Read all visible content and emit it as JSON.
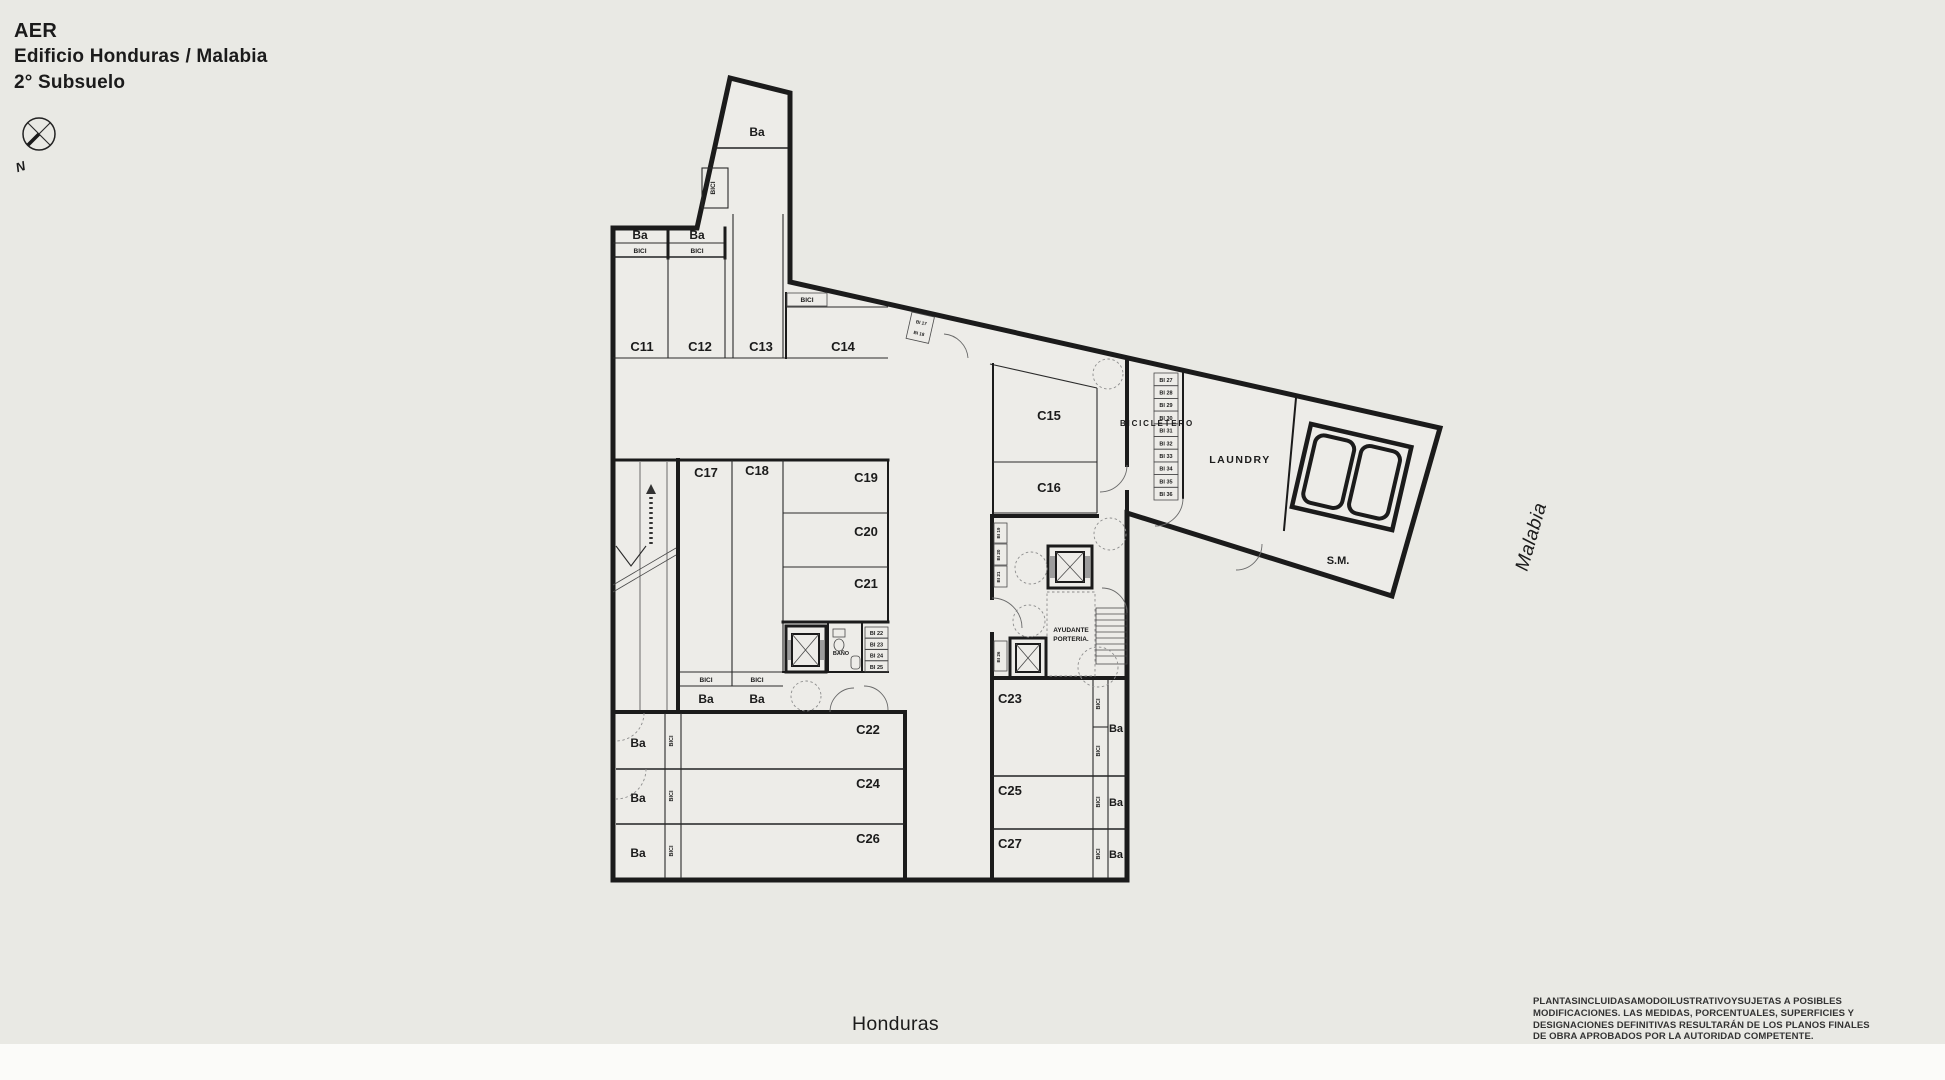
{
  "header": {
    "brand": "AER",
    "building": "Edificio Honduras / Malabia",
    "level": "2° Subsuelo"
  },
  "compass": {
    "north": "N"
  },
  "streets": {
    "bottom": "Honduras",
    "side": "Malabia"
  },
  "disclaimer": {
    "line1": "PLANTASINCLUIDASAMODOILUSTRATIVOYSUJETAS A POSIBLES",
    "line2": "MODIFICACIONES. LAS MEDIDAS, PORCENTUALES, SUPERFICIES Y",
    "line3": "DESIGNACIONES DEFINITIVAS RESULTARÁN DE LOS PLANOS FINALES",
    "line4": "DE OBRA APROBADOS POR LA AUTORIDAD COMPETENTE."
  },
  "plan": {
    "rooms": {
      "c11": "C11",
      "c12": "C12",
      "c13": "C13",
      "c14": "C14",
      "c15": "C15",
      "c16": "C16",
      "c17": "C17",
      "c18": "C18",
      "c19": "C19",
      "c20": "C20",
      "c21": "C21",
      "c22": "C22",
      "c23": "C23",
      "c24": "C24",
      "c25": "C25",
      "c26": "C26",
      "c27": "C27"
    },
    "labels": {
      "ba": "Ba",
      "bici": "BICI",
      "banio": "BAÑO",
      "laundry": "LAUNDRY",
      "sala_maquinas": "S.M.",
      "bicicletero": "BICICLETERO",
      "ayudante": "AYUDANTE",
      "porteria": "PORTERIA."
    },
    "bike_spots": {
      "bi17": "BI 17",
      "bi18": "BI 18",
      "bi19": "BI 19",
      "bi20": "BI 20",
      "bi21": "BI 21",
      "bi22": "BI 22",
      "bi23": "BI 23",
      "bi24": "BI 24",
      "bi25": "BI 25",
      "bi26": "BI 26",
      "bi27": "BI 27",
      "bi28": "BI 28",
      "bi29": "BI 29",
      "bi30": "BI 30",
      "bi31": "BI 31",
      "bi32": "BI 32",
      "bi33": "BI 33",
      "bi34": "BI 34",
      "bi35": "BI 35",
      "bi36": "BI 36"
    },
    "colors": {
      "wall": "#1b1b1b",
      "canvas": "#e9e9e4",
      "room_fill": "#edece8",
      "paper_white": "#fbfbf9"
    }
  }
}
